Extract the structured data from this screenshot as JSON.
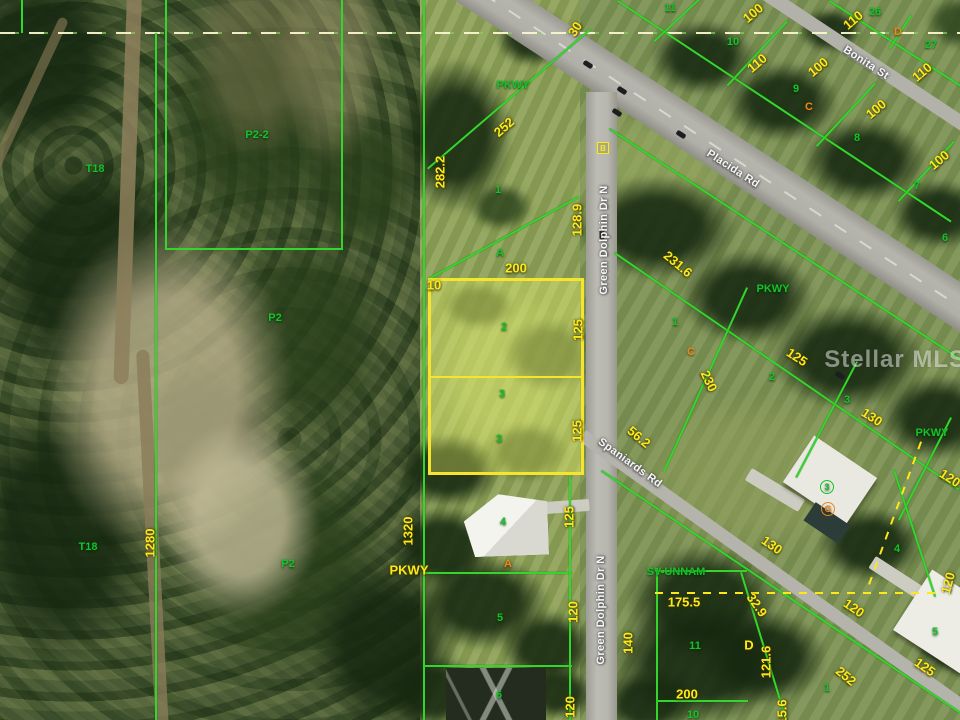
{
  "watermark": "Stellar MLS",
  "map": {
    "colors": {
      "parcel_line_green": "#36d52d",
      "dimension_yellow": "#ffe81a",
      "highlight_border": "#f6e52c",
      "highlight_fill": "rgba(246,255,110,0.33)",
      "marker_orange": "#e78a1d",
      "road_label_white": "#f7f7f7"
    },
    "roads": [
      {
        "name": "Placida Rd"
      },
      {
        "name": "Bonita St"
      },
      {
        "name": "Green Dolphin Dr N"
      },
      {
        "name": "Spaniards Rd"
      }
    ],
    "highlight_parcel": {
      "lot_numbers": [
        "2",
        "3"
      ],
      "frontage": "200",
      "depth": "125"
    },
    "labels": [
      {
        "t": "Placida Rd",
        "x": 733,
        "y": 169,
        "r": 33,
        "k": "r"
      },
      {
        "t": "Bonita St",
        "x": 866,
        "y": 63,
        "r": 33,
        "k": "r"
      },
      {
        "t": "Green Dolphin Dr N",
        "x": 604,
        "y": 240,
        "r": -90,
        "k": "r"
      },
      {
        "t": "Green Dolphin Dr N",
        "x": 601,
        "y": 610,
        "r": -90,
        "k": "r"
      },
      {
        "t": "Spaniards Rd",
        "x": 630,
        "y": 463,
        "r": 36,
        "k": "r"
      },
      {
        "t": "30",
        "x": 575,
        "y": 29,
        "r": -57,
        "k": "y"
      },
      {
        "t": "252",
        "x": 504,
        "y": 127,
        "r": -41,
        "k": "y"
      },
      {
        "t": "282.2",
        "x": 440,
        "y": 172,
        "r": -90,
        "k": "y"
      },
      {
        "t": "128.9",
        "x": 577,
        "y": 220,
        "r": -90,
        "k": "y"
      },
      {
        "t": "200",
        "x": 516,
        "y": 268,
        "r": 0,
        "k": "y"
      },
      {
        "t": "10",
        "x": 434,
        "y": 285,
        "r": 0,
        "k": "y"
      },
      {
        "t": "125",
        "x": 578,
        "y": 330,
        "r": -90,
        "k": "y"
      },
      {
        "t": "125",
        "x": 577,
        "y": 431,
        "r": -90,
        "k": "y"
      },
      {
        "t": "125",
        "x": 569,
        "y": 517,
        "r": -90,
        "k": "y"
      },
      {
        "t": "1320",
        "x": 408,
        "y": 531,
        "r": -90,
        "k": "y"
      },
      {
        "t": "PKWY",
        "x": 409,
        "y": 570,
        "r": 0,
        "k": "y"
      },
      {
        "t": "120",
        "x": 573,
        "y": 612,
        "r": -90,
        "k": "y"
      },
      {
        "t": "120",
        "x": 570,
        "y": 707,
        "r": -90,
        "k": "y"
      },
      {
        "t": "1280",
        "x": 150,
        "y": 543,
        "r": -90,
        "k": "y"
      },
      {
        "t": "100",
        "x": 753,
        "y": 13,
        "r": -40,
        "k": "y"
      },
      {
        "t": "110",
        "x": 757,
        "y": 63,
        "r": -40,
        "k": "y"
      },
      {
        "t": "100",
        "x": 818,
        "y": 67,
        "r": -40,
        "k": "y"
      },
      {
        "t": "100",
        "x": 876,
        "y": 109,
        "r": -40,
        "k": "y"
      },
      {
        "t": "100",
        "x": 939,
        "y": 160,
        "r": -40,
        "k": "y"
      },
      {
        "t": "110",
        "x": 853,
        "y": 20,
        "r": -40,
        "k": "y"
      },
      {
        "t": "110",
        "x": 922,
        "y": 72,
        "r": -40,
        "k": "y"
      },
      {
        "t": "231.6",
        "x": 678,
        "y": 264,
        "r": 40,
        "k": "y"
      },
      {
        "t": "230",
        "x": 709,
        "y": 381,
        "r": 65,
        "k": "y"
      },
      {
        "t": "125",
        "x": 797,
        "y": 357,
        "r": 33,
        "k": "y"
      },
      {
        "t": "130",
        "x": 872,
        "y": 417,
        "r": 33,
        "k": "y"
      },
      {
        "t": "120",
        "x": 950,
        "y": 478,
        "r": 33,
        "k": "y"
      },
      {
        "t": "56.2",
        "x": 639,
        "y": 437,
        "r": 40,
        "k": "y"
      },
      {
        "t": "175.5",
        "x": 684,
        "y": 602,
        "r": 0,
        "k": "y"
      },
      {
        "t": "32.9",
        "x": 757,
        "y": 605,
        "r": 55,
        "k": "y"
      },
      {
        "t": "130",
        "x": 772,
        "y": 545,
        "r": 35,
        "k": "y"
      },
      {
        "t": "120",
        "x": 854,
        "y": 608,
        "r": 35,
        "k": "y"
      },
      {
        "t": "140",
        "x": 628,
        "y": 643,
        "r": -90,
        "k": "y"
      },
      {
        "t": "D",
        "x": 749,
        "y": 645,
        "r": 0,
        "k": "y"
      },
      {
        "t": "121.6",
        "x": 766,
        "y": 662,
        "r": -90,
        "k": "y"
      },
      {
        "t": "200",
        "x": 687,
        "y": 694,
        "r": 0,
        "k": "y"
      },
      {
        "t": "252",
        "x": 846,
        "y": 676,
        "r": 40,
        "k": "y"
      },
      {
        "t": "15.6",
        "x": 782,
        "y": 712,
        "r": -90,
        "k": "y"
      },
      {
        "t": "125",
        "x": 925,
        "y": 667,
        "r": 35,
        "k": "y"
      },
      {
        "t": "120",
        "x": 948,
        "y": 583,
        "r": -75,
        "k": "y"
      },
      {
        "t": "P2-2",
        "x": 257,
        "y": 135,
        "r": 0,
        "k": "g"
      },
      {
        "t": "T18",
        "x": 95,
        "y": 169,
        "r": 0,
        "k": "g"
      },
      {
        "t": "P2",
        "x": 275,
        "y": 318,
        "r": 0,
        "k": "g"
      },
      {
        "t": "T18",
        "x": 88,
        "y": 547,
        "r": 0,
        "k": "g"
      },
      {
        "t": "P2",
        "x": 288,
        "y": 564,
        "r": 0,
        "k": "g"
      },
      {
        "t": "PKWY",
        "x": 513,
        "y": 85,
        "r": 0,
        "k": "g"
      },
      {
        "t": "1",
        "x": 498,
        "y": 190,
        "r": 0,
        "k": "g"
      },
      {
        "t": "A",
        "x": 500,
        "y": 253,
        "r": 0,
        "k": "g"
      },
      {
        "t": "2",
        "x": 504,
        "y": 327,
        "r": 0,
        "k": "g"
      },
      {
        "t": "3",
        "x": 502,
        "y": 394,
        "r": 0,
        "k": "g"
      },
      {
        "t": "3",
        "x": 499,
        "y": 439,
        "r": 0,
        "k": "g"
      },
      {
        "t": "4",
        "x": 503,
        "y": 522,
        "r": 0,
        "k": "g"
      },
      {
        "t": "5",
        "x": 500,
        "y": 618,
        "r": 0,
        "k": "g"
      },
      {
        "t": "6",
        "x": 499,
        "y": 695,
        "r": 0,
        "k": "g"
      },
      {
        "t": "11",
        "x": 670,
        "y": 8,
        "r": 0,
        "k": "g"
      },
      {
        "t": "10",
        "x": 733,
        "y": 42,
        "r": 0,
        "k": "g"
      },
      {
        "t": "9",
        "x": 796,
        "y": 89,
        "r": 0,
        "k": "g"
      },
      {
        "t": "8",
        "x": 857,
        "y": 138,
        "r": 0,
        "k": "g"
      },
      {
        "t": "7",
        "x": 917,
        "y": 186,
        "r": 0,
        "k": "g"
      },
      {
        "t": "6",
        "x": 945,
        "y": 238,
        "r": 0,
        "k": "g"
      },
      {
        "t": "26",
        "x": 875,
        "y": 12,
        "r": 0,
        "k": "g"
      },
      {
        "t": "27",
        "x": 931,
        "y": 45,
        "r": 0,
        "k": "g"
      },
      {
        "t": "PKWY",
        "x": 773,
        "y": 289,
        "r": 0,
        "k": "g"
      },
      {
        "t": "1",
        "x": 675,
        "y": 322,
        "r": 0,
        "k": "g"
      },
      {
        "t": "2",
        "x": 772,
        "y": 377,
        "r": 0,
        "k": "g"
      },
      {
        "t": "3",
        "x": 847,
        "y": 400,
        "r": 0,
        "k": "g"
      },
      {
        "t": "PKWY",
        "x": 932,
        "y": 433,
        "r": 0,
        "k": "g"
      },
      {
        "t": "SV-UNNAM",
        "x": 676,
        "y": 572,
        "r": 0,
        "k": "g"
      },
      {
        "t": "11",
        "x": 695,
        "y": 646,
        "r": 0,
        "k": "g"
      },
      {
        "t": "10",
        "x": 693,
        "y": 715,
        "r": 0,
        "k": "g"
      },
      {
        "t": "1",
        "x": 827,
        "y": 688,
        "r": 0,
        "k": "g"
      },
      {
        "t": "4",
        "x": 897,
        "y": 549,
        "r": 0,
        "k": "g"
      },
      {
        "t": "5",
        "x": 935,
        "y": 632,
        "r": 0,
        "k": "g"
      },
      {
        "t": "3",
        "x": 827,
        "y": 487,
        "r": 0,
        "k": "g circ"
      },
      {
        "t": "C",
        "x": 809,
        "y": 107,
        "r": 0,
        "k": "o"
      },
      {
        "t": "D",
        "x": 898,
        "y": 32,
        "r": 0,
        "k": "o"
      },
      {
        "t": "C",
        "x": 691,
        "y": 352,
        "r": 0,
        "k": "o"
      },
      {
        "t": "A",
        "x": 508,
        "y": 564,
        "r": 0,
        "k": "o"
      },
      {
        "t": "G",
        "x": 828,
        "y": 509,
        "r": 0,
        "k": "o circ"
      },
      {
        "t": "B",
        "x": 603,
        "y": 148,
        "r": 0,
        "k": "ybox"
      }
    ]
  }
}
